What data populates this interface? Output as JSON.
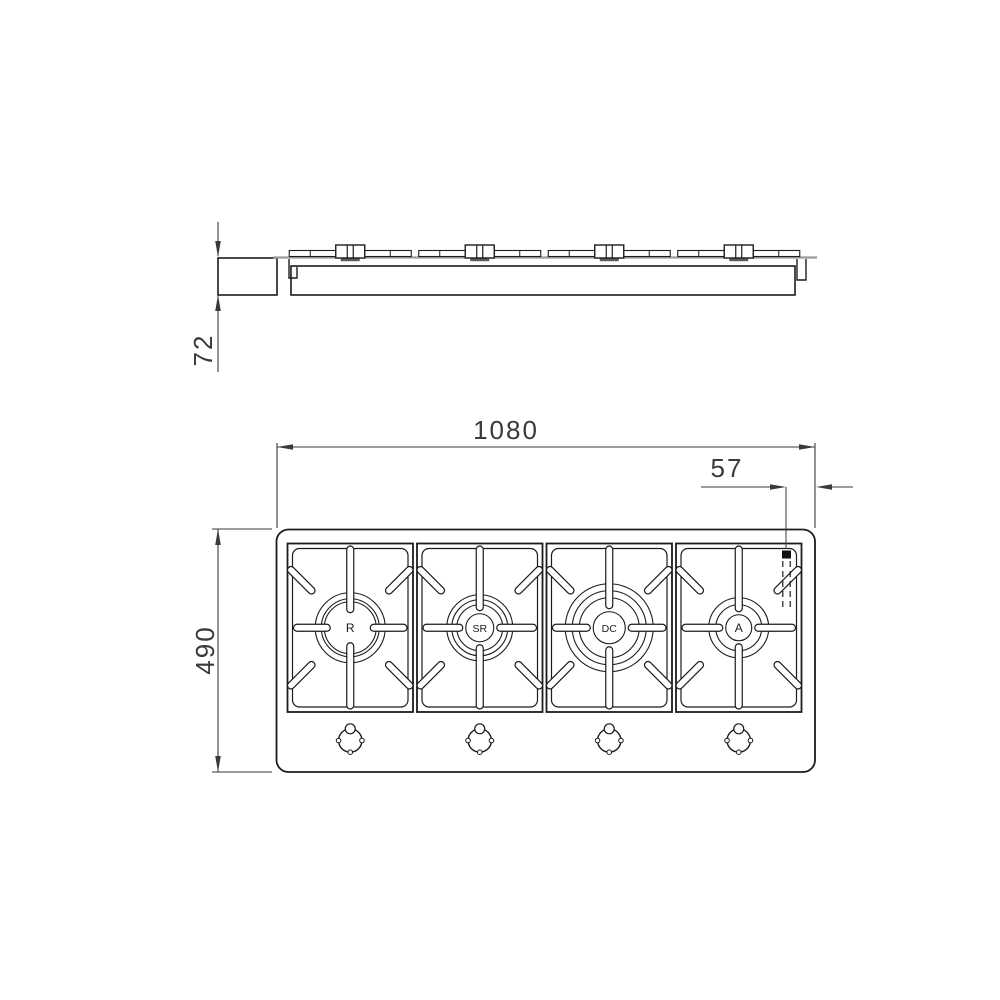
{
  "drawing": {
    "line_color": "#1c1c1c",
    "dim_color": "#3a3a3a",
    "surface_line_color": "#9a9a9a",
    "side_view": {
      "height_dim": "72"
    },
    "top_view": {
      "width_dim": "1080",
      "corner_offset_dim": "57",
      "depth_dim": "490",
      "burners": [
        {
          "label": "R",
          "rings": [
            35,
            29,
            26
          ],
          "center_circle_r": 0
        },
        {
          "label": "SR",
          "rings": [
            33,
            28,
            23
          ],
          "center_circle_r": 14
        },
        {
          "label": "DC",
          "rings": [
            44,
            37,
            30
          ],
          "center_circle_r": 16
        },
        {
          "label": "A",
          "rings": [
            30,
            23
          ],
          "center_circle_r": 13
        }
      ],
      "knob_count": 4,
      "igniter_marker": "corner-ignition-point"
    }
  }
}
